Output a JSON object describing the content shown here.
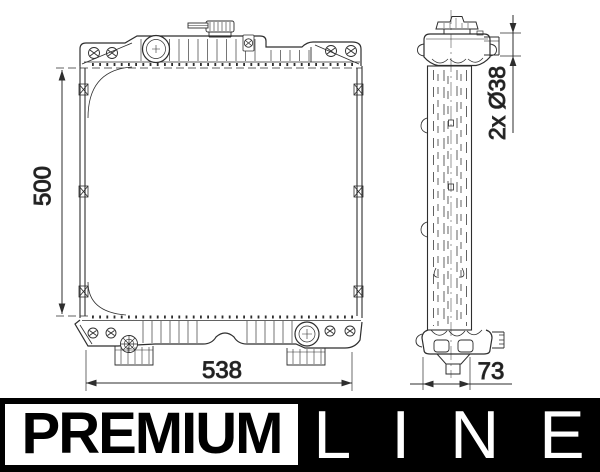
{
  "banner": {
    "premium_label": "PREMIUM",
    "line_label": "LINE",
    "bg_color": "#000000",
    "box_color": "#ffffff"
  },
  "dimensions": {
    "height": "500",
    "width": "538",
    "depth": "73",
    "pipe_ports": "2x Ø38"
  },
  "drawing": {
    "line_color": "#2e2e2e"
  }
}
